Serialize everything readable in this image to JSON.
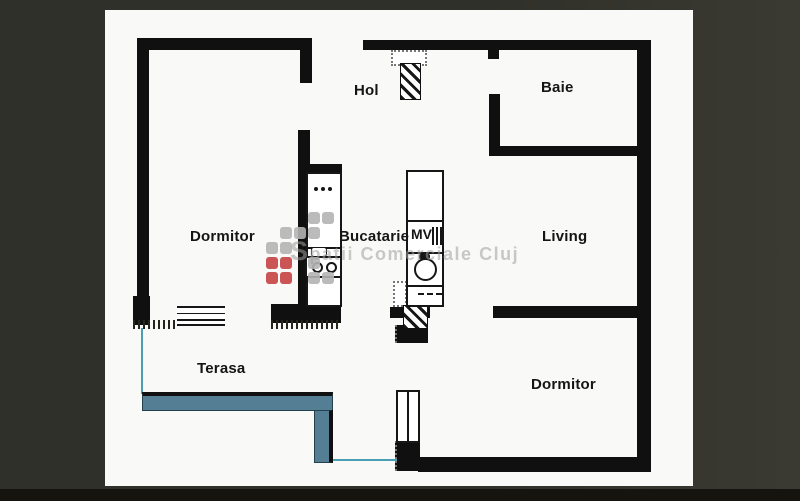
{
  "plan_title": "Apartment floor plan",
  "rooms": {
    "hol": {
      "label": "Hol"
    },
    "baie": {
      "label": "Baie"
    },
    "dormitor_left": {
      "label": "Dormitor"
    },
    "bucatarie": {
      "label": "Bucatarie"
    },
    "living": {
      "label": "Living"
    },
    "terasa": {
      "label": "Terasa"
    },
    "dormitor_bottom": {
      "label": "Dormitor"
    }
  },
  "fixtures": {
    "appliance_label": "MV"
  },
  "watermark": {
    "text": "Spatii Comerciale Cluj"
  },
  "colors": {
    "background": "#30302a",
    "background_edge": "#3a3a32",
    "page": "#f9f9f7",
    "wall": "#101010",
    "rail_fill": "#547e94",
    "rail_line": "#49a0b5",
    "wm_gray": "#b4b4b4",
    "wm_red": "#c84b4b",
    "wm_text": "#9f9f9f",
    "label": "#151515",
    "strip": "#15140f"
  }
}
